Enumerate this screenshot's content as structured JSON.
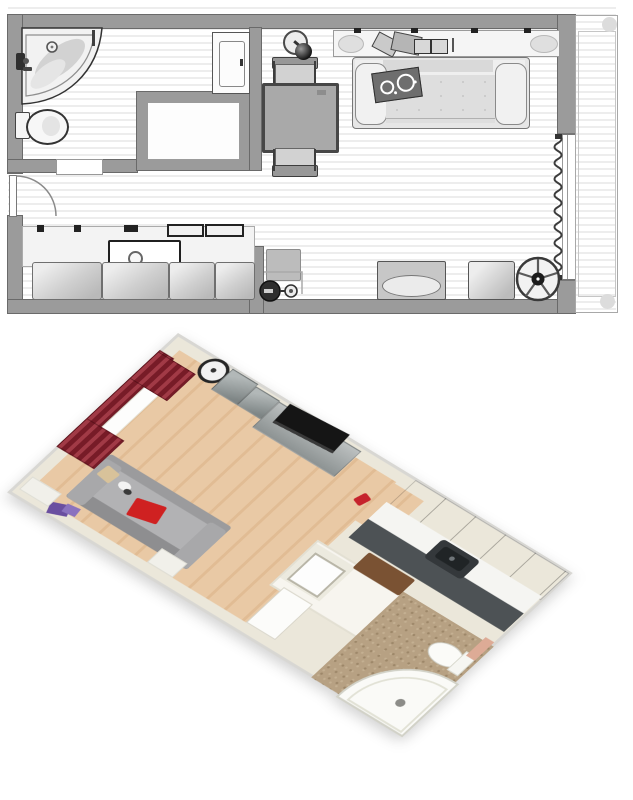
{
  "app": {
    "description_label": "Studio apartment – 2D floor plan above, 3D aerial render below"
  },
  "floor_plan": {
    "label": "2D floor plan",
    "rooms": [
      "bathroom",
      "hallway",
      "kitchen",
      "living-room",
      "balcony"
    ],
    "items": [
      "corner-bathtub",
      "toilet",
      "bathroom-door",
      "entrance-door",
      "built-in-closet",
      "wardrobe-cabinet",
      "kitchen-counter",
      "kitchen-sink",
      "base-cabinets",
      "counter-items",
      "vacuum-cleaner",
      "dining-table",
      "chair-top",
      "chair-bottom",
      "floor-lamp",
      "wall-shelf",
      "shelf-books",
      "sofa",
      "patterned-pillow",
      "pet-bed",
      "pouf",
      "fan",
      "window",
      "curtain",
      "balcony-floor"
    ],
    "tooltips": {
      "bathtub": "Corner bathtub",
      "toilet": "Toilet",
      "bath_door": "Bathroom door",
      "entry_door": "Entrance door",
      "closet": "Built-in closet",
      "wardrobe": "Wardrobe cabinet",
      "counter": "Kitchen counter",
      "sink": "Kitchen sink",
      "cabinet": "Kitchen base cabinet",
      "vacuum": "Vacuum cleaner",
      "table": "Dining table",
      "chair": "Chair",
      "lamp": "Floor lamp",
      "shelf": "Wall shelf",
      "sofa": "Sofa",
      "pillow": "Patterned pillow",
      "pet_bed": "Pet bed",
      "pouf": "Pouf",
      "fan": "Fan",
      "window": "Window",
      "curtain": "Curtain",
      "balcony": "Balcony"
    },
    "colors": {
      "wall_gray": "#9b9b9b",
      "wall_outline": "#6a6a6a",
      "floor_stripe": "#ededed",
      "furniture_light": "#d9d9d9",
      "table_gray": "#a9a9a9",
      "line_dark": "#3d3d3d"
    }
  },
  "view_3d": {
    "label": "3D aerial view",
    "items": [
      "red-curtains",
      "window",
      "wall-clock",
      "cube-shelves",
      "tv",
      "tv-sideboard",
      "wood-floor",
      "gray-sofa",
      "red-pillow",
      "beige-pillow",
      "purple-book",
      "white-ledges",
      "white-wardrobe",
      "washbasin",
      "wooden-bench",
      "partition-walls",
      "kitchen-upper-cabinets",
      "kitchen-counter",
      "kitchen-base-units",
      "kitchen-sink",
      "red-floor-object",
      "bathroom-tile-floor",
      "corner-bathtub",
      "toilet",
      "mirror"
    ],
    "tooltips": {
      "curtains": "Red curtains",
      "clock": "Wall clock",
      "tv": "TV",
      "sofa": "Sofa",
      "pillow": "Red pillow",
      "book": "Purple book",
      "wardrobe": "Wardrobe",
      "basin": "Washbasin",
      "bench": "Wooden bench",
      "uppers": "Kitchen upper cabinets",
      "sink": "Kitchen sink",
      "tub": "Corner bathtub",
      "toilet": "Toilet"
    },
    "colors": {
      "wall_cream": "#ebe7da",
      "wall_rim": "#d8d7d3",
      "wood_floor": "#e7c6a1",
      "tile_floor": "#b7a183",
      "sofa_gray": "#9b9b9d",
      "curtain_red": "#8d2330",
      "pillow_red": "#cf2121",
      "book_purple": "#6a4fa0",
      "cabinet_gray": "#8d9393",
      "counter_white": "#f5f5f2",
      "kitchen_base_dark": "#4d5255",
      "tv_black": "#151515",
      "item_red": "#c6232c",
      "bench_brown": "#7a5233"
    }
  }
}
